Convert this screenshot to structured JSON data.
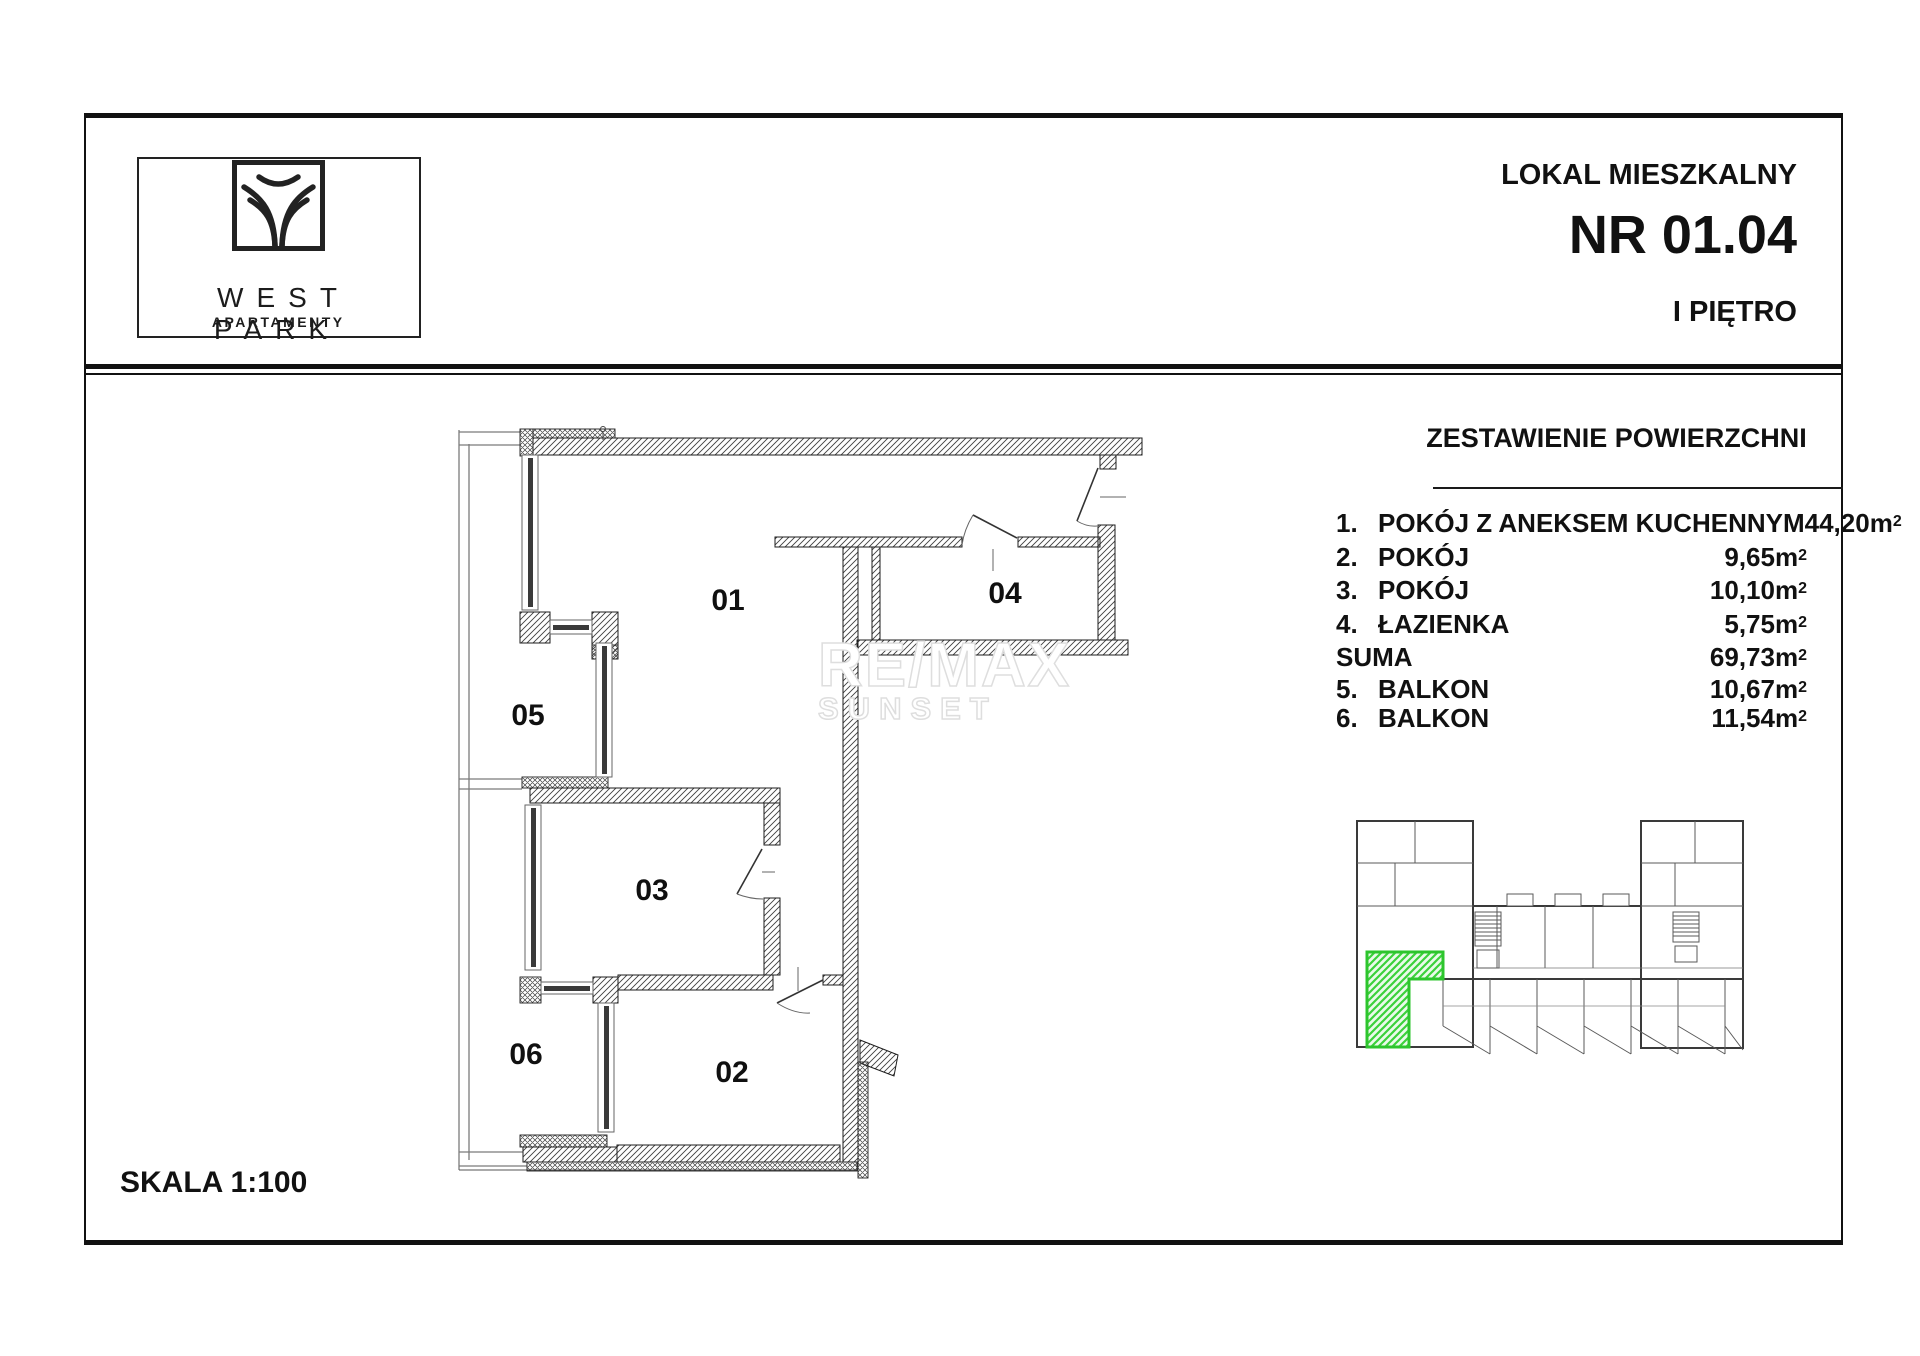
{
  "logo": {
    "brand": "WEST PARK",
    "subtitle": "APARTAMENTY"
  },
  "header": {
    "unit_type": "LOKAL MIESZKALNY",
    "unit_number": "NR 01.04",
    "floor": "I PIĘTRO"
  },
  "areas": {
    "title": "ZESTAWIENIE POWIERZCHNI",
    "rows": [
      {
        "no": "1.",
        "label": "POKÓJ Z ANEKSEM KUCHENNYM",
        "value": "44,20m",
        "sup": "2"
      },
      {
        "no": "2.",
        "label": "POKÓJ",
        "value": "9,65m",
        "sup": "2"
      },
      {
        "no": "3.",
        "label": "POKÓJ",
        "value": "10,10m",
        "sup": "2"
      },
      {
        "no": "4.",
        "label": "ŁAZIENKA",
        "value": "5,75m",
        "sup": "2"
      },
      {
        "no": "",
        "label": "SUMA",
        "value": "69,73m",
        "sup": "2"
      },
      {
        "no": "5.",
        "label": "BALKON",
        "value": "10,67m",
        "sup": "2"
      },
      {
        "no": "6.",
        "label": "BALKON",
        "value": "11,54m",
        "sup": "2"
      }
    ]
  },
  "plan": {
    "scale_label": "SKALA 1:100",
    "room_labels": [
      "01",
      "04",
      "05",
      "03",
      "06",
      "02"
    ]
  },
  "watermark": {
    "line1": "RE/MAX",
    "line2": "SUNSET"
  },
  "colors": {
    "highlight_green": "#2dc52d",
    "wall": "#1d1d1d"
  }
}
